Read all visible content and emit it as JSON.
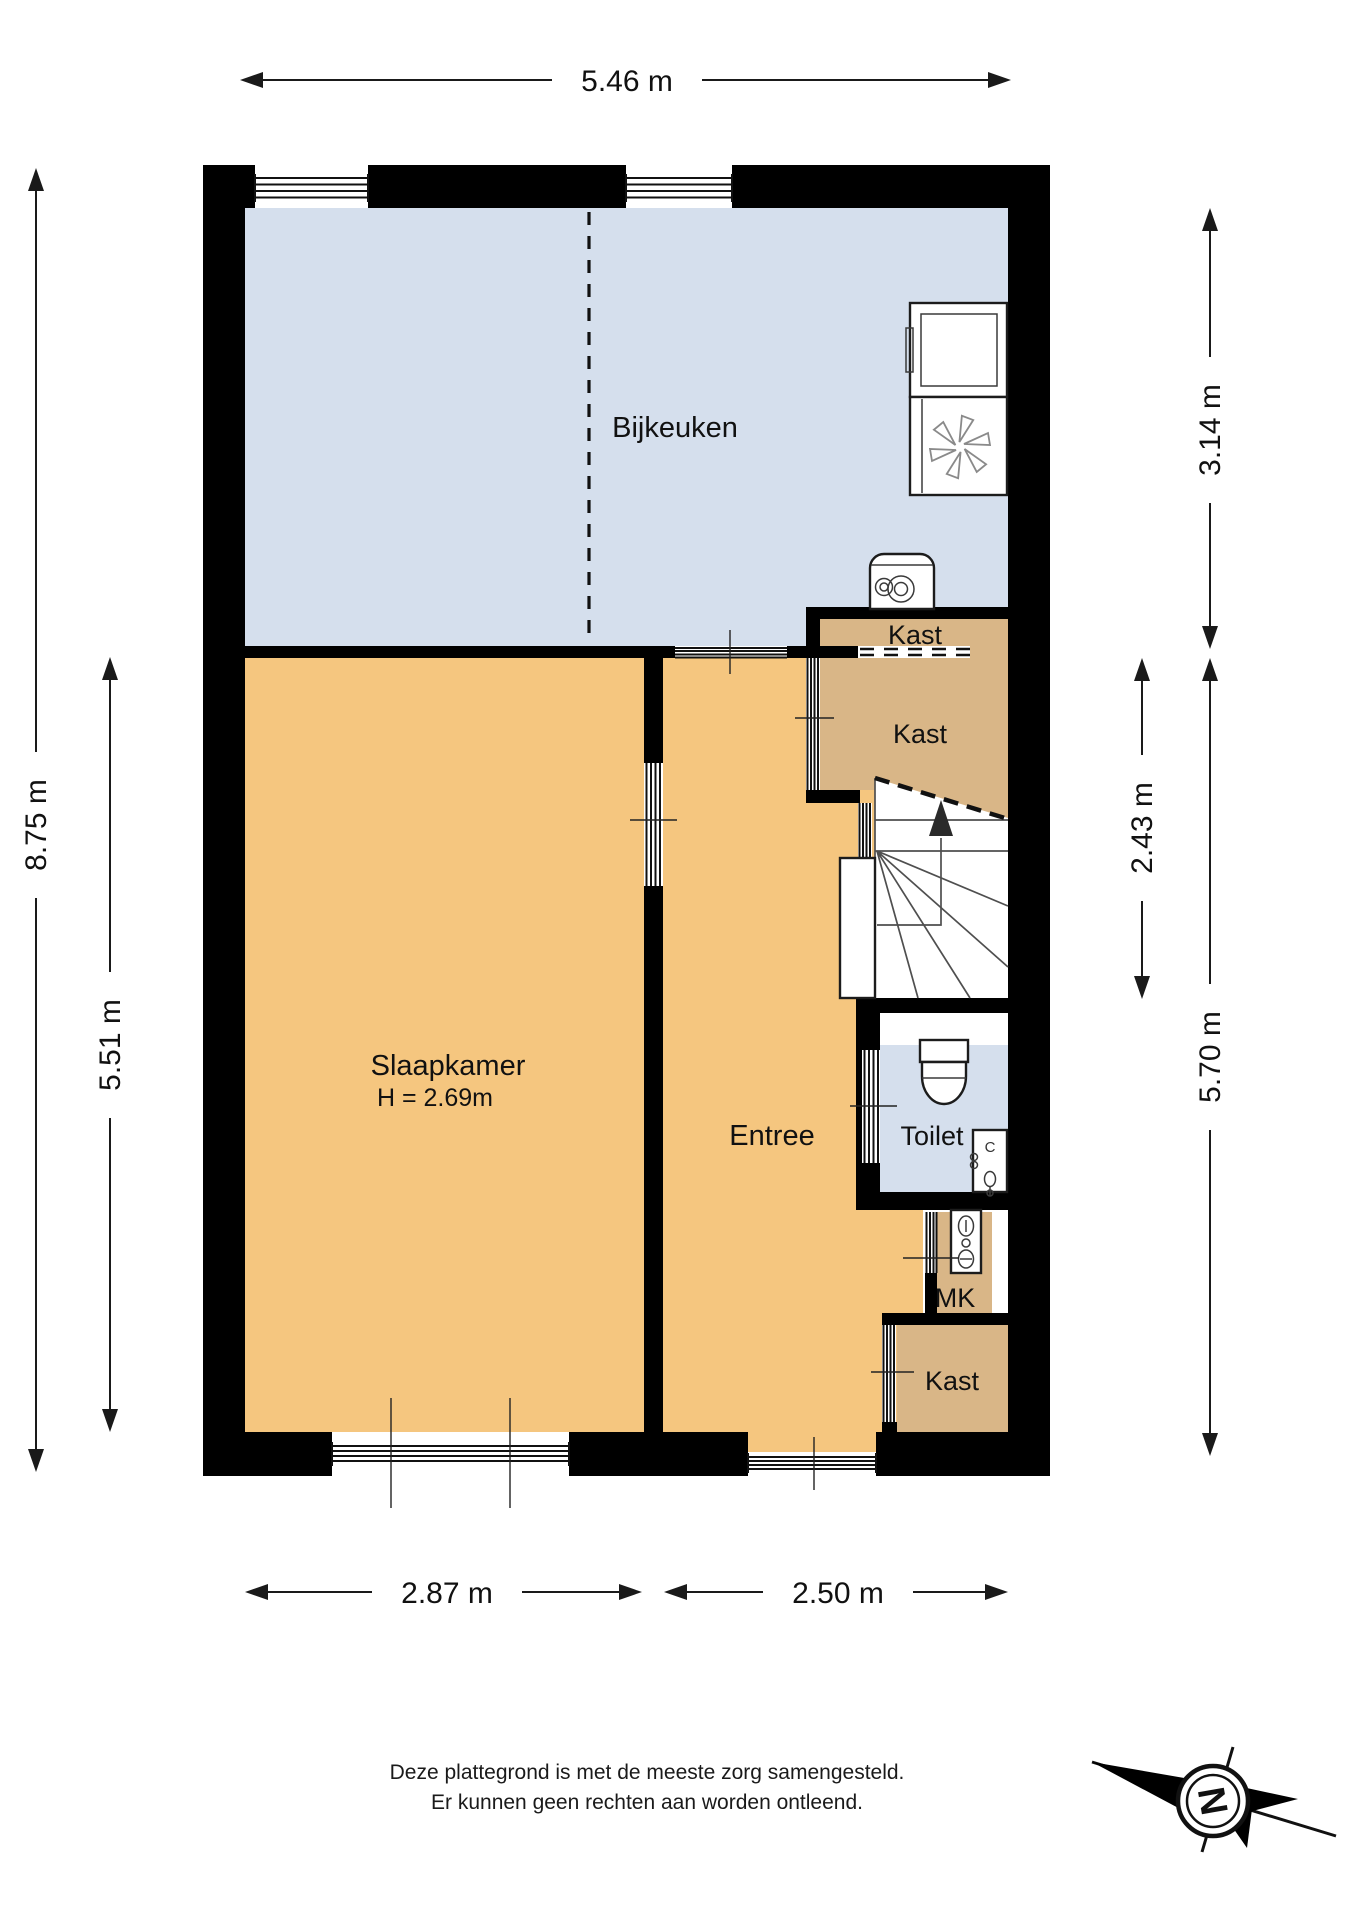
{
  "colors": {
    "wall": "#000000",
    "room_blue": "#d5dfed",
    "room_orange": "#f5c67f",
    "room_tan": "#d9b687",
    "white": "#ffffff"
  },
  "rooms": {
    "bijkeuken": {
      "label": "Bijkeuken"
    },
    "slaapkamer": {
      "label": "Slaapkamer",
      "height_note": "H = 2.69m"
    },
    "entree": {
      "label": "Entree"
    },
    "toilet": {
      "label": "Toilet"
    },
    "kast_top": {
      "label": "Kast"
    },
    "kast_stairs": {
      "label": "Kast"
    },
    "meterkast": {
      "label": "MK"
    },
    "kast_bottom": {
      "label": "Kast"
    }
  },
  "dimensions": {
    "top_width": "5.46 m",
    "left_total_height": "8.75 m",
    "left_room_height": "5.51 m",
    "right_top_height": "3.14 m",
    "right_mid_height": "2.43 m",
    "right_bottom_height": "5.70 m",
    "bottom_left_width": "2.87 m",
    "bottom_right_width": "2.50 m"
  },
  "fixtures": {
    "sink_tap_label": "C"
  },
  "compass": {
    "north_label": "N"
  },
  "disclaimer": {
    "line1": "Deze plattegrond is met de meeste zorg samengesteld.",
    "line2": "Er kunnen geen rechten aan worden ontleend."
  }
}
